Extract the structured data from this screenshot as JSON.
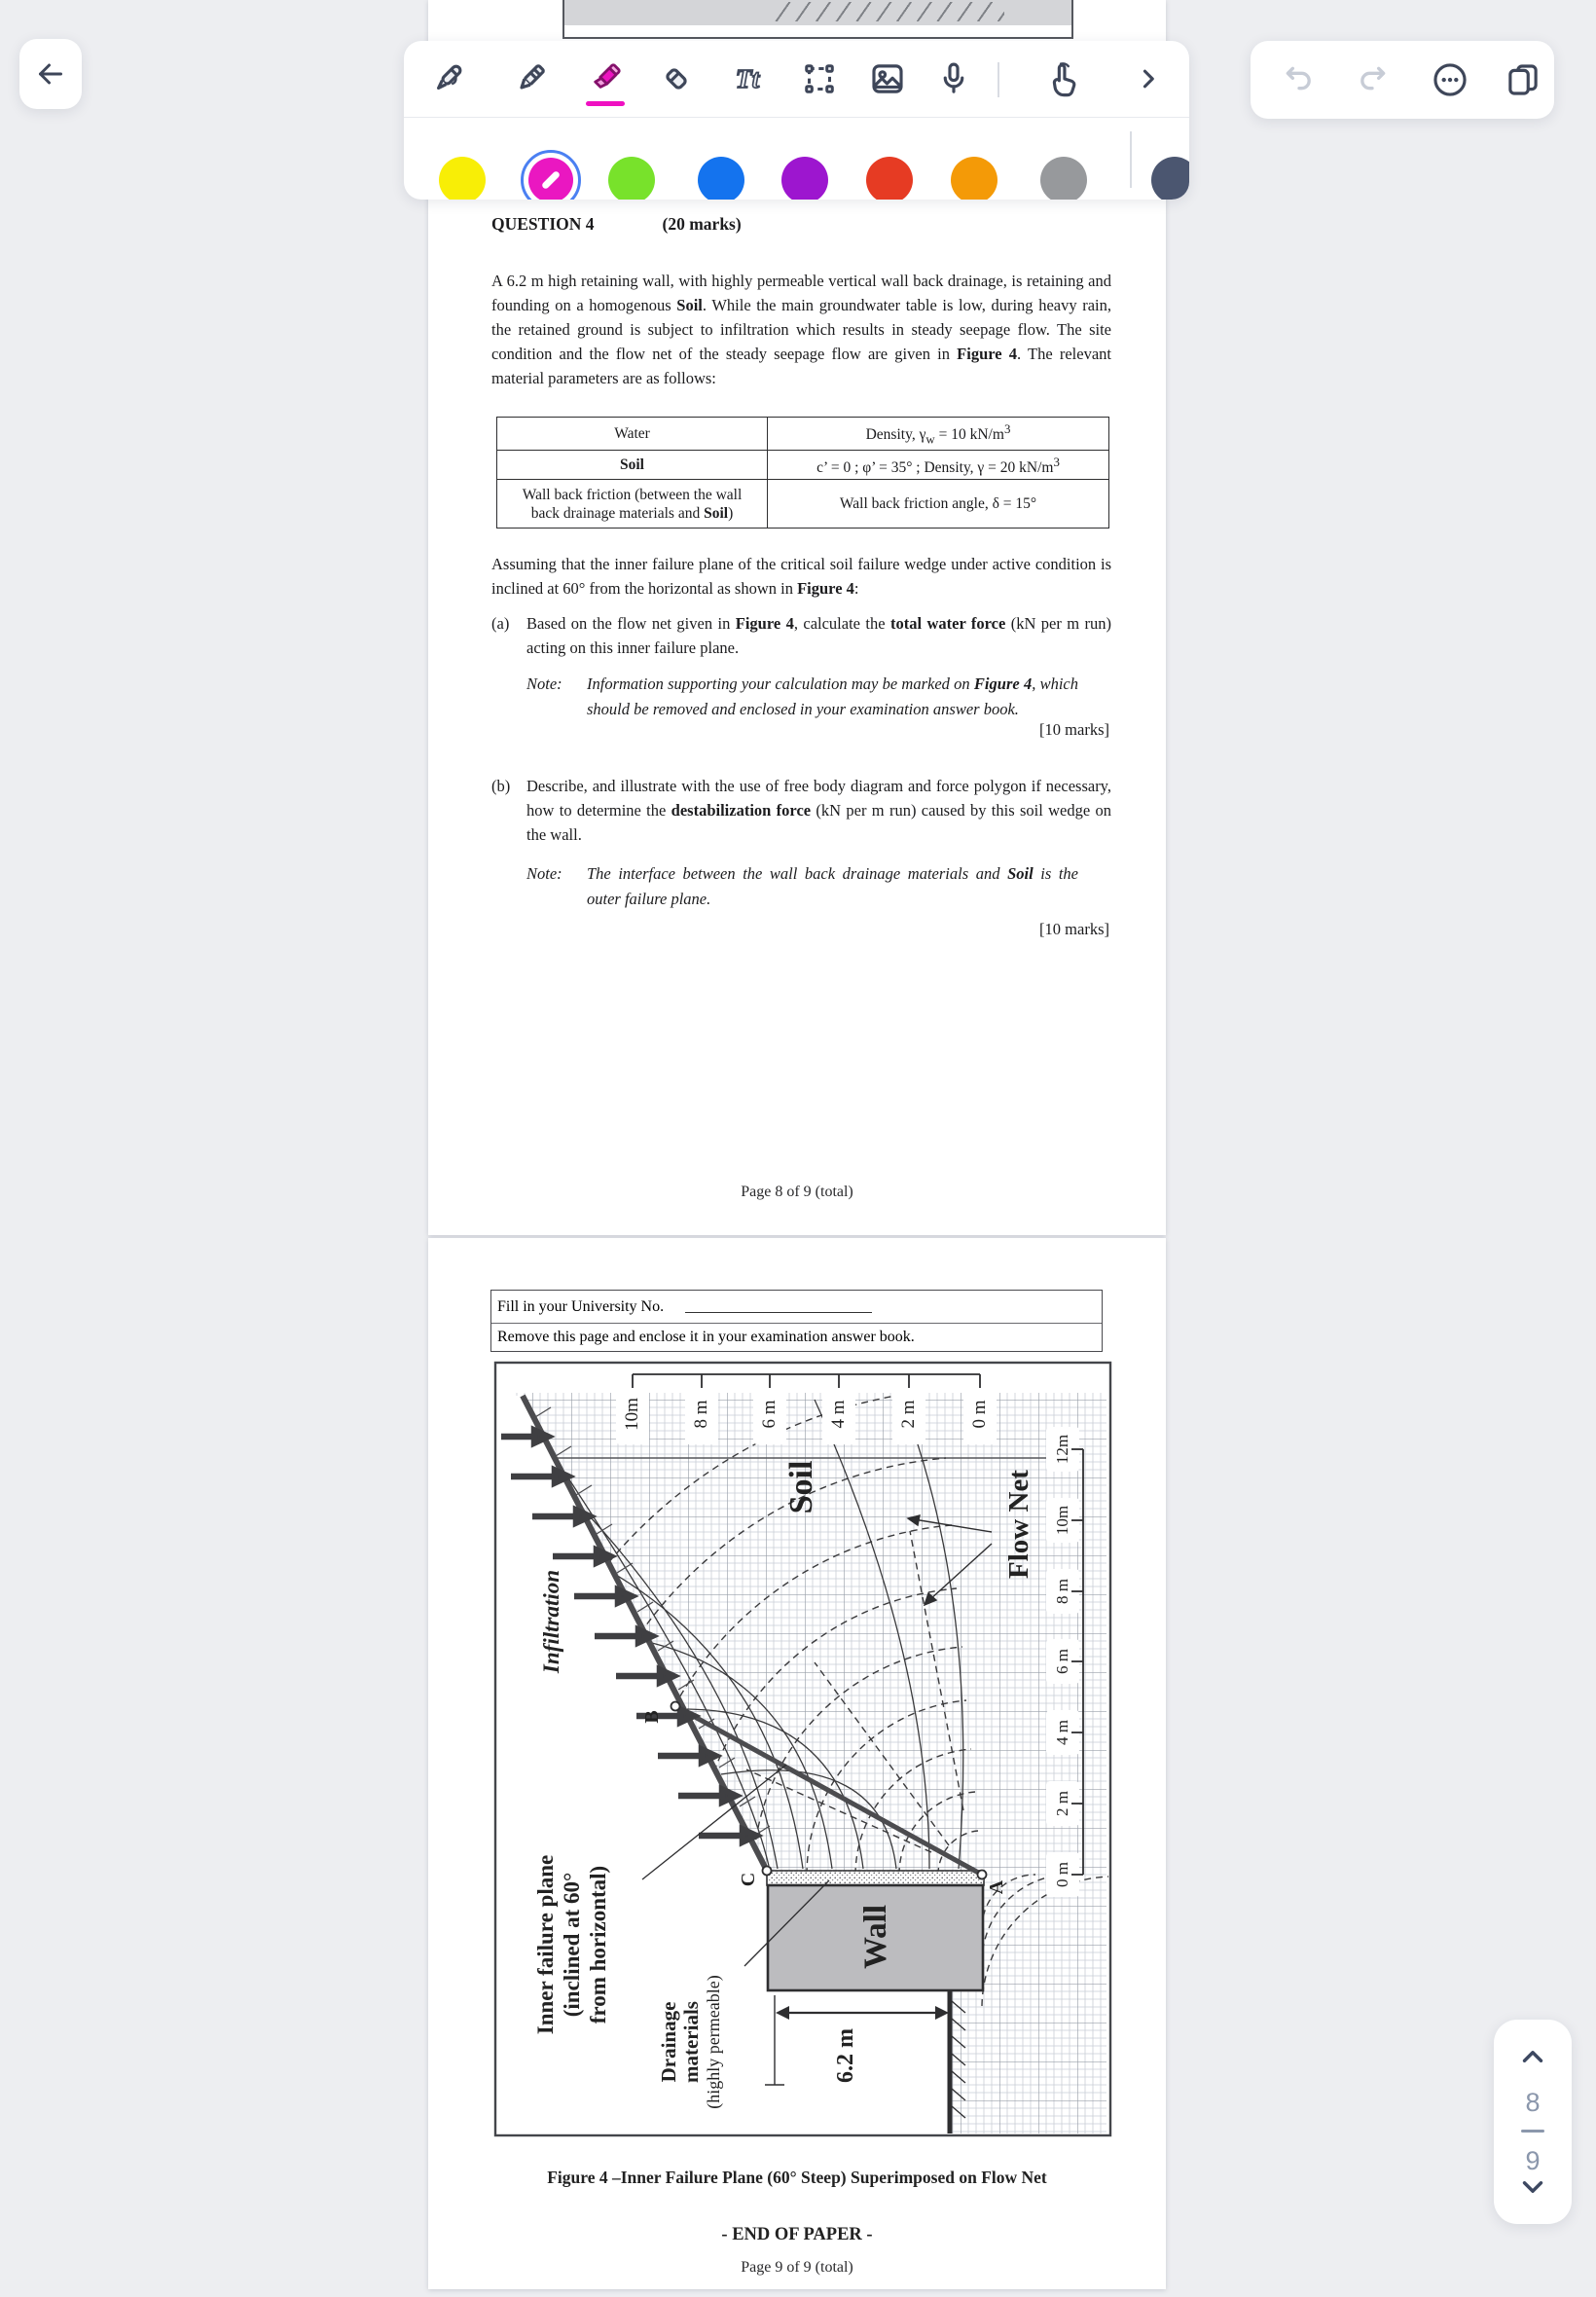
{
  "ui": {
    "back_icon": "left-arrow",
    "toolbar": {
      "tools": [
        "pen",
        "pencil",
        "highlighter",
        "eraser",
        "text",
        "lasso",
        "image",
        "microphone",
        "pointer",
        "expand"
      ],
      "selected_tool": "highlighter",
      "text_tool_glyph": "Tt",
      "highlight_color": "#ef10c1"
    },
    "colors": {
      "swatches": [
        {
          "name": "yellow",
          "hex": "#f8ee06"
        },
        {
          "name": "magenta",
          "hex": "#ea17c1",
          "selected": true
        },
        {
          "name": "green",
          "hex": "#78e22b"
        },
        {
          "name": "blue",
          "hex": "#1473ee"
        },
        {
          "name": "purple",
          "hex": "#9d16cf"
        },
        {
          "name": "red",
          "hex": "#e63b23"
        },
        {
          "name": "orange",
          "hex": "#f49a07"
        },
        {
          "name": "gray",
          "hex": "#97999c"
        }
      ],
      "custom_picker_hex": "#4b5670"
    },
    "actions": [
      "undo",
      "redo",
      "more",
      "copy"
    ],
    "page_nav": {
      "current": "8",
      "next": "9"
    }
  },
  "page8": {
    "question_no": "QUESTION 4",
    "marks": "(20 marks)",
    "intro1": "A 6.2 m high retaining wall, with highly permeable vertical wall back drainage, is retaining and founding on a homogenous ",
    "intro2": "Soil",
    "intro3": ".   While the main groundwater table is low, during heavy rain, the retained ground is subject to infiltration which results in steady seepage flow.   The site condition and the flow net of the steady seepage flow are given in ",
    "intro4": "Figure 4",
    "intro5": ".   The relevant material parameters are as follows:",
    "table": {
      "r1c1": "Water",
      "r1c2a": "Density, γ",
      "r1c2sub": "w",
      "r1c2b": " = 10 kN/m",
      "r1c2sup": "3",
      "r2c1": "Soil",
      "r2c2a": "c’ = 0 ;   φ’ = 35° ;   Density, γ = 20 kN/m",
      "r2c2sup": "3",
      "r3c1a": "Wall back friction (between the wall",
      "r3c1b": "back drainage materials and ",
      "r3c1c": "Soil",
      "r3c1d": ")",
      "r3c2": "Wall back friction angle,  δ  =  15°"
    },
    "assuming1": "Assuming that the inner failure plane of the critical soil failure wedge under active condition is inclined at 60° from the horizontal as shown in ",
    "assuming2": "Figure 4",
    "assuming3": ":",
    "a_label": "(a)",
    "a1": "Based on the flow net given in ",
    "a2": "Figure 4",
    "a3": ", calculate the ",
    "a4": "total water force",
    "a5": " (kN per m run) acting on this inner failure plane.",
    "note_label": "Note:",
    "na1": "Information supporting your calculation may be marked on ",
    "na2": "Figure 4",
    "na3": ", which should be removed and enclosed in your examination answer book.",
    "a_marks": "[10 marks]",
    "b_label": "(b)",
    "b1": "Describe, and illustrate with the use of free body diagram and force polygon if necessary, how to determine the ",
    "b2": "destabilization force",
    "b3": " (kN per m run) caused by this soil wedge on the wall.",
    "nb1": "The interface between the wall back drainage materials and ",
    "nb2": "Soil",
    "nb3": " is the outer failure plane.",
    "b_marks": "[10 marks]",
    "footer": "Page 8 of 9 (total)"
  },
  "page9": {
    "fill_in": "Fill in your University No.",
    "remove_line": "Remove this page and enclose it in your examination answer book.",
    "figure": {
      "top_scale": [
        "10m",
        "8 m",
        "6 m",
        "4 m",
        "2 m",
        "0 m"
      ],
      "right_scale": [
        "12m",
        "10m",
        "8 m",
        "6 m",
        "4 m",
        "2 m",
        "0 m"
      ],
      "soil": "Soil",
      "flow_net": "Flow Net",
      "infiltration": "Infiltration",
      "ifp1": "Inner failure plane",
      "ifp2": "(inclined at 60°",
      "ifp3": "from horizontal)",
      "dr1": "Drainage",
      "dr2": "materials",
      "dr3": "(highly permeable)",
      "wall": "Wall",
      "dim": "6.2 m",
      "pA": "A",
      "pB": "B",
      "pC": "C"
    },
    "caption": "Figure 4 –Inner Failure Plane (60° Steep) Superimposed on Flow Net",
    "end": "- END OF PAPER -",
    "footer": "Page 9 of 9 (total)"
  }
}
